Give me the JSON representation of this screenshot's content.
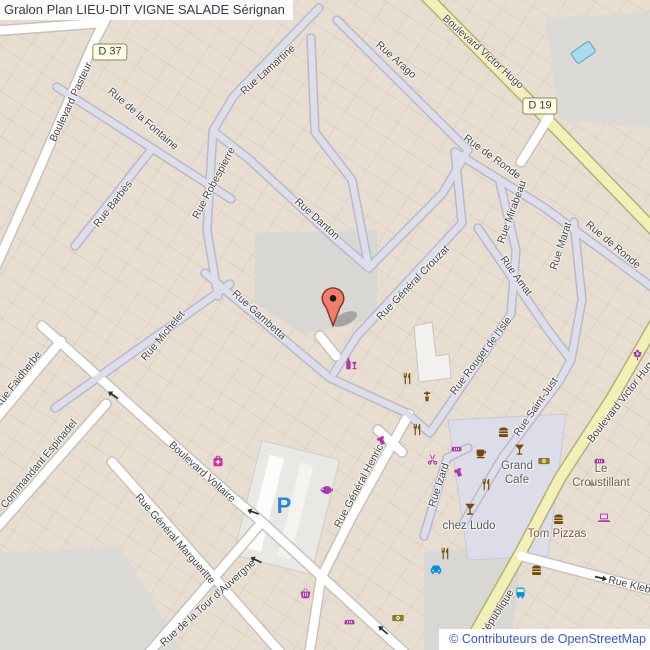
{
  "title": {
    "text": "Gralon Plan LIEU-DIT VIGNE SALADE Sérignan"
  },
  "attribution": {
    "text": "© Contributeurs de OpenStreetMap"
  },
  "colors": {
    "shop_magenta": "#ac39ac",
    "food_brown": "#734a08",
    "money_olive": "#8a7d1d",
    "transport_blue": "#0092da",
    "parking_blue": "#2e86d8",
    "marker_fill": "#ef7e6c",
    "primary_road": "#f3f0b5",
    "minor_road": "#dddeea"
  },
  "route_badges": [
    {
      "label": "D 37",
      "x": 110,
      "y": 52
    },
    {
      "label": "D 19",
      "x": 540,
      "y": 106
    }
  ],
  "street_labels": [
    {
      "text": "Boulevard Pasteur",
      "x": 71,
      "y": 102,
      "rot": -65
    },
    {
      "text": "Rue de la Fontaine",
      "x": 143,
      "y": 119,
      "rot": 41
    },
    {
      "text": "Rue Lamartine",
      "x": 268,
      "y": 70,
      "rot": -42
    },
    {
      "text": "Rue Arago",
      "x": 396,
      "y": 60,
      "rot": 42
    },
    {
      "text": "Boulevard Victor Hugo",
      "x": 483,
      "y": 52,
      "rot": 42
    },
    {
      "text": "Rue Barbès",
      "x": 113,
      "y": 204,
      "rot": -52
    },
    {
      "text": "Rue Robespierre",
      "x": 214,
      "y": 183,
      "rot": -62
    },
    {
      "text": "Rue Danton",
      "x": 317,
      "y": 219,
      "rot": 42
    },
    {
      "text": "Rue de Ronde",
      "x": 492,
      "y": 157,
      "rot": 36
    },
    {
      "text": "Rue de Ronde",
      "x": 613,
      "y": 245,
      "rot": 40
    },
    {
      "text": "Rue Mirabeau",
      "x": 512,
      "y": 212,
      "rot": -70
    },
    {
      "text": "Rue Marat",
      "x": 561,
      "y": 246,
      "rot": -72
    },
    {
      "text": "Rue Amat",
      "x": 516,
      "y": 276,
      "rot": 54
    },
    {
      "text": "Rue Général Crouzat",
      "x": 413,
      "y": 283,
      "rot": -46
    },
    {
      "text": "Rue Rouget de l'Isle",
      "x": 481,
      "y": 356,
      "rot": -53
    },
    {
      "text": "Rue Saint-Just",
      "x": 536,
      "y": 407,
      "rot": -55
    },
    {
      "text": "Rue Michelet",
      "x": 163,
      "y": 336,
      "rot": -50
    },
    {
      "text": "Rue Gambetta",
      "x": 259,
      "y": 315,
      "rot": 42
    },
    {
      "text": "Rue Faidherbe",
      "x": 18,
      "y": 380,
      "rot": -52
    },
    {
      "text": "Commandant Espinadel",
      "x": 39,
      "y": 464,
      "rot": -50
    },
    {
      "text": "Boulevard Voltaire",
      "x": 202,
      "y": 472,
      "rot": 42
    },
    {
      "text": "Rue Général Margueritte",
      "x": 175,
      "y": 539,
      "rot": 49
    },
    {
      "text": "Rue de la Tour d'Auvergne",
      "x": 208,
      "y": 603,
      "rot": -42
    },
    {
      "text": "Rue Général Henric",
      "x": 359,
      "y": 486,
      "rot": -62
    },
    {
      "text": "Rue Izard",
      "x": 439,
      "y": 485,
      "rot": -72
    },
    {
      "text": "Boulevard Victor Hugo",
      "x": 622,
      "y": 400,
      "rot": -52
    },
    {
      "text": "République",
      "x": 497,
      "y": 613,
      "rot": -57
    },
    {
      "text": "Rue Kleber",
      "x": 634,
      "y": 586,
      "rot": 14
    }
  ],
  "place_labels": [
    {
      "text": "Grand\nCafe",
      "x": 517,
      "y": 474,
      "color": "#5c5c5c"
    },
    {
      "text": "chez Ludo",
      "x": 469,
      "y": 527,
      "color": "#5c5c5c"
    },
    {
      "text": "Le Croustillant",
      "x": 601,
      "y": 477,
      "color": "#7a5b3c"
    },
    {
      "text": "Tom Pizzas",
      "x": 557,
      "y": 535,
      "color": "#7a5b3c"
    }
  ],
  "parking": {
    "label": "P",
    "x": 284,
    "y": 506
  },
  "poi_icons": [
    {
      "icon": "wine",
      "x": 351,
      "y": 364,
      "color": "#ac39ac",
      "size": 14
    },
    {
      "icon": "restaurant",
      "x": 407,
      "y": 378,
      "color": "#734a08",
      "size": 13
    },
    {
      "icon": "water",
      "x": 427,
      "y": 396,
      "color": "#734a08",
      "size": 12
    },
    {
      "icon": "restaurant",
      "x": 417,
      "y": 429,
      "color": "#734a08",
      "size": 13
    },
    {
      "icon": "clothes",
      "x": 381,
      "y": 440,
      "color": "#ac39ac",
      "size": 13
    },
    {
      "icon": "pharmacy",
      "x": 218,
      "y": 461,
      "color": "#d12aa2",
      "size": 14
    },
    {
      "icon": "fish",
      "x": 326,
      "y": 490,
      "color": "#ac39ac",
      "size": 14
    },
    {
      "icon": "hairdresser",
      "x": 432,
      "y": 459,
      "color": "#ac39ac",
      "size": 13
    },
    {
      "icon": "bakery",
      "x": 456,
      "y": 448,
      "color": "#ac39ac",
      "size": 13
    },
    {
      "icon": "cafe",
      "x": 481,
      "y": 452,
      "color": "#734a08",
      "size": 13
    },
    {
      "icon": "clothes",
      "x": 458,
      "y": 472,
      "color": "#ac39ac",
      "size": 13
    },
    {
      "icon": "restaurant",
      "x": 486,
      "y": 484,
      "color": "#734a08",
      "size": 13
    },
    {
      "icon": "bar",
      "x": 470,
      "y": 509,
      "color": "#734a08",
      "size": 14
    },
    {
      "icon": "fastfood",
      "x": 503,
      "y": 432,
      "color": "#734a08",
      "size": 13
    },
    {
      "icon": "bar",
      "x": 519,
      "y": 449,
      "color": "#734a08",
      "size": 13
    },
    {
      "icon": "money",
      "x": 544,
      "y": 461,
      "color": "#8a7d1d",
      "size": 14
    },
    {
      "icon": "bakery",
      "x": 599,
      "y": 460,
      "color": "#ac39ac",
      "size": 13
    },
    {
      "icon": "dot",
      "x": 592,
      "y": 484,
      "color": "#8f8d8a",
      "size": 6
    },
    {
      "icon": "fastfood",
      "x": 558,
      "y": 519,
      "color": "#734a08",
      "size": 13
    },
    {
      "icon": "laptop",
      "x": 604,
      "y": 518,
      "color": "#ac39ac",
      "size": 14
    },
    {
      "icon": "restaurant",
      "x": 445,
      "y": 553,
      "color": "#734a08",
      "size": 13
    },
    {
      "icon": "car",
      "x": 436,
      "y": 569,
      "color": "#0092da",
      "size": 14
    },
    {
      "icon": "basket",
      "x": 305,
      "y": 593,
      "color": "#ac39ac",
      "size": 13
    },
    {
      "icon": "bakery",
      "x": 349,
      "y": 621,
      "color": "#ac39ac",
      "size": 13
    },
    {
      "icon": "money",
      "x": 398,
      "y": 618,
      "color": "#8a7d1d",
      "size": 14
    },
    {
      "icon": "fastfood",
      "x": 536,
      "y": 570,
      "color": "#734a08",
      "size": 13
    },
    {
      "icon": "bus",
      "x": 520,
      "y": 592,
      "color": "#0092da",
      "size": 13
    },
    {
      "icon": "florist",
      "x": 637,
      "y": 354,
      "color": "#ac39ac",
      "size": 13
    }
  ],
  "oneway_arrows": [
    {
      "x": 113,
      "y": 395,
      "rot": 215
    },
    {
      "x": 253,
      "y": 512,
      "rot": 200
    },
    {
      "x": 256,
      "y": 560,
      "rot": 205
    },
    {
      "x": 383,
      "y": 630,
      "rot": 221
    },
    {
      "x": 601,
      "y": 578,
      "rot": 13
    }
  ],
  "marker": {
    "x": 333,
    "y": 326
  }
}
